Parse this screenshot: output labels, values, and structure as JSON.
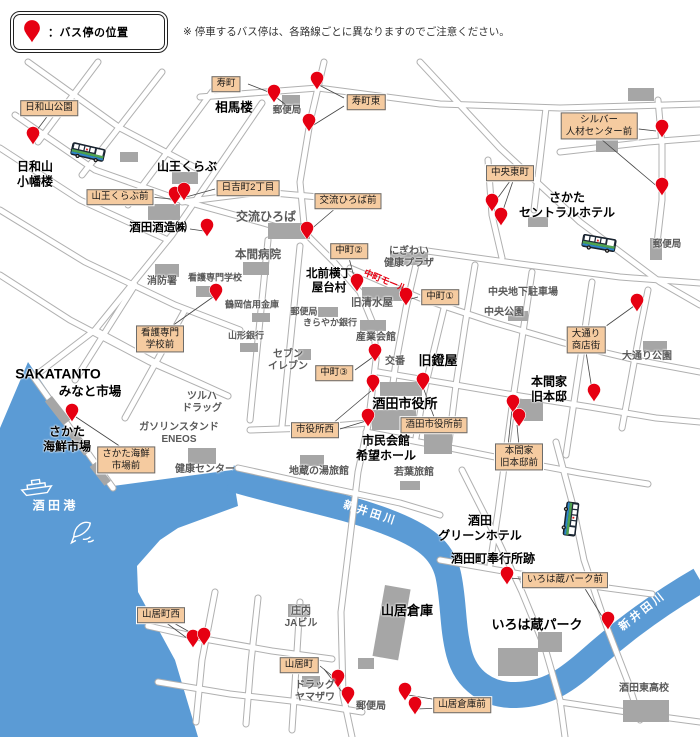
{
  "legend": {
    "label": "：バス停の位置",
    "note": "※ 停車するバス停は、各路線ごとに異なりますのでご注意ください。"
  },
  "colors": {
    "pin": "#e60012",
    "water": "#5b9bd5",
    "road_casing": "#b0b0b0",
    "building": "#a6a6a6",
    "label_bg": "#f5cba0",
    "mall_red": "#e60012"
  },
  "map": {
    "tan_labels": [
      {
        "t": "日和山公園",
        "x": 49,
        "y": 108
      },
      {
        "t": "寿町",
        "x": 226,
        "y": 84
      },
      {
        "t": "寿町東",
        "x": 366,
        "y": 102
      },
      {
        "t": "日吉町2丁目",
        "x": 248,
        "y": 188
      },
      {
        "t": "交流ひろば前",
        "x": 348,
        "y": 201
      },
      {
        "t": "山王くらぶ前",
        "x": 120,
        "y": 197
      },
      {
        "t": "シルバー\n人材センター前",
        "x": 599,
        "y": 126
      },
      {
        "t": "中央東町",
        "x": 510,
        "y": 173
      },
      {
        "t": "中町②",
        "x": 349,
        "y": 251
      },
      {
        "t": "中町①",
        "x": 440,
        "y": 297
      },
      {
        "t": "中町③",
        "x": 334,
        "y": 373
      },
      {
        "t": "看護専門\n学校前",
        "x": 160,
        "y": 339
      },
      {
        "t": "市役所西",
        "x": 315,
        "y": 430
      },
      {
        "t": "酒田市役所前",
        "x": 434,
        "y": 425
      },
      {
        "t": "大通り\n商店街",
        "x": 586,
        "y": 340
      },
      {
        "t": "本間家\n旧本邸前",
        "x": 519,
        "y": 457
      },
      {
        "t": "さかた海鮮\n市場前",
        "x": 126,
        "y": 460
      },
      {
        "t": "いろは蔵パーク前",
        "x": 565,
        "y": 580
      },
      {
        "t": "山居町西",
        "x": 161,
        "y": 615
      },
      {
        "t": "山居町",
        "x": 299,
        "y": 665
      },
      {
        "t": "山居倉庫前",
        "x": 462,
        "y": 705
      }
    ],
    "bold_names": [
      {
        "t": "日和山\n小幡楼",
        "x": 35,
        "y": 174,
        "fs": 12
      },
      {
        "t": "相馬楼",
        "x": 234,
        "y": 108,
        "fs": 12.5
      },
      {
        "t": "山王くらぶ",
        "x": 187,
        "y": 167,
        "fs": 12
      },
      {
        "t": "酒田酒造㈱",
        "x": 158,
        "y": 228,
        "fs": 11.5
      },
      {
        "t": "さかた\nセントラルホテル",
        "x": 567,
        "y": 205,
        "fs": 12
      },
      {
        "t": "北前横丁\n屋台村",
        "x": 329,
        "y": 281,
        "fs": 11.5
      },
      {
        "t": "旧鐙屋",
        "x": 438,
        "y": 361,
        "fs": 13
      },
      {
        "t": "酒田市役所",
        "x": 405,
        "y": 404,
        "fs": 13
      },
      {
        "t": "本間家\n旧本邸",
        "x": 549,
        "y": 389,
        "fs": 12
      },
      {
        "t": "SAKATANTO",
        "x": 58,
        "y": 374,
        "fs": 14
      },
      {
        "t": "みなと市場",
        "x": 90,
        "y": 392,
        "fs": 12.5
      },
      {
        "t": "さかた\n海鮮市場",
        "x": 67,
        "y": 439,
        "fs": 12
      },
      {
        "t": "市民会館\n希望ホール",
        "x": 386,
        "y": 448,
        "fs": 12
      },
      {
        "t": "酒田\nグリーンホテル",
        "x": 480,
        "y": 528,
        "fs": 12
      },
      {
        "t": "酒田町奉行所跡",
        "x": 493,
        "y": 559,
        "fs": 12
      },
      {
        "t": "山居倉庫",
        "x": 407,
        "y": 611,
        "fs": 13
      },
      {
        "t": "いろは蔵パーク",
        "x": 537,
        "y": 625,
        "fs": 13
      }
    ],
    "gray_names": [
      {
        "t": "郵便局",
        "x": 287,
        "y": 111,
        "fs": 9.5
      },
      {
        "t": "交流ひろば",
        "x": 266,
        "y": 217,
        "fs": 12
      },
      {
        "t": "にぎわい\n健康プラザ",
        "x": 409,
        "y": 258,
        "fs": 10
      },
      {
        "t": "本間病院",
        "x": 258,
        "y": 255,
        "fs": 11.5
      },
      {
        "t": "消防署",
        "x": 162,
        "y": 282,
        "fs": 10
      },
      {
        "t": "看護専門学校",
        "x": 215,
        "y": 278,
        "fs": 9
      },
      {
        "t": "鶴岡信用金庫",
        "x": 252,
        "y": 305,
        "fs": 9
      },
      {
        "t": "郵便局",
        "x": 304,
        "y": 312,
        "fs": 9
      },
      {
        "t": "きらやか銀行",
        "x": 330,
        "y": 323,
        "fs": 9
      },
      {
        "t": "山形銀行",
        "x": 246,
        "y": 336,
        "fs": 9
      },
      {
        "t": "旧清水屋",
        "x": 372,
        "y": 303,
        "fs": 10.5
      },
      {
        "t": "産業会館",
        "x": 376,
        "y": 338,
        "fs": 10
      },
      {
        "t": "セブン\nイレブン",
        "x": 288,
        "y": 361,
        "fs": 10
      },
      {
        "t": "交番",
        "x": 395,
        "y": 362,
        "fs": 10
      },
      {
        "t": "中央地下駐車場",
        "x": 523,
        "y": 293,
        "fs": 10
      },
      {
        "t": "中央公園",
        "x": 504,
        "y": 313,
        "fs": 10
      },
      {
        "t": "大通り公園",
        "x": 647,
        "y": 357,
        "fs": 10
      },
      {
        "t": "郵便局",
        "x": 667,
        "y": 245,
        "fs": 9.5
      },
      {
        "t": "ツルハ\nドラッグ",
        "x": 202,
        "y": 403,
        "fs": 10
      },
      {
        "t": "ガソリンスタンド\nENEOS",
        "x": 179,
        "y": 434,
        "fs": 10
      },
      {
        "t": "健康センター",
        "x": 205,
        "y": 470,
        "fs": 10
      },
      {
        "t": "地蔵の湯旅館",
        "x": 319,
        "y": 472,
        "fs": 10
      },
      {
        "t": "若葉旅館",
        "x": 414,
        "y": 473,
        "fs": 10
      },
      {
        "t": "庄内\nJAビル",
        "x": 301,
        "y": 618,
        "fs": 10
      },
      {
        "t": "ドラッグ\nヤマザワ",
        "x": 315,
        "y": 692,
        "fs": 10
      },
      {
        "t": "郵便局",
        "x": 371,
        "y": 707,
        "fs": 10
      },
      {
        "t": "酒田東高校",
        "x": 644,
        "y": 689,
        "fs": 10
      }
    ],
    "special_texts": [
      {
        "t": "中町モール",
        "x": 385,
        "y": 281,
        "fs": 9,
        "rot": 22,
        "c": "#e60012",
        "name": "street-name-nakamachi-mall"
      },
      {
        "t": "酒 田 港",
        "x": 54,
        "y": 506,
        "fs": 12,
        "rot": 0,
        "c": "#ffffff",
        "name": "water-name-sakata-port"
      },
      {
        "t": "新井田川",
        "x": 370,
        "y": 514,
        "fs": 11,
        "rot": 18,
        "c": "#ffffff",
        "ls": 3,
        "name": "river-name-niida-1"
      },
      {
        "t": "新井田川",
        "x": 643,
        "y": 612,
        "fs": 11,
        "rot": -38,
        "c": "#ffffff",
        "ls": 3,
        "name": "river-name-niida-2"
      }
    ],
    "pins": [
      {
        "x": 33,
        "y": 145
      },
      {
        "x": 175,
        "y": 205
      },
      {
        "x": 184,
        "y": 201
      },
      {
        "x": 207,
        "y": 237
      },
      {
        "x": 274,
        "y": 103
      },
      {
        "x": 317,
        "y": 90
      },
      {
        "x": 309,
        "y": 132
      },
      {
        "x": 307,
        "y": 240
      },
      {
        "x": 662,
        "y": 138
      },
      {
        "x": 662,
        "y": 196
      },
      {
        "x": 492,
        "y": 212
      },
      {
        "x": 501,
        "y": 226
      },
      {
        "x": 216,
        "y": 302
      },
      {
        "x": 357,
        "y": 292
      },
      {
        "x": 406,
        "y": 306
      },
      {
        "x": 375,
        "y": 362
      },
      {
        "x": 373,
        "y": 393
      },
      {
        "x": 423,
        "y": 391
      },
      {
        "x": 368,
        "y": 427
      },
      {
        "x": 72,
        "y": 422
      },
      {
        "x": 637,
        "y": 312
      },
      {
        "x": 594,
        "y": 402
      },
      {
        "x": 513,
        "y": 413
      },
      {
        "x": 519,
        "y": 427
      },
      {
        "x": 507,
        "y": 585
      },
      {
        "x": 608,
        "y": 630
      },
      {
        "x": 193,
        "y": 648
      },
      {
        "x": 204,
        "y": 646
      },
      {
        "x": 338,
        "y": 688
      },
      {
        "x": 348,
        "y": 705
      },
      {
        "x": 405,
        "y": 701
      },
      {
        "x": 415,
        "y": 715
      }
    ],
    "buses": [
      {
        "x": 88,
        "y": 152,
        "rot": 13
      },
      {
        "x": 599,
        "y": 243,
        "rot": 10
      },
      {
        "x": 571,
        "y": 519,
        "rot": 97
      }
    ]
  }
}
